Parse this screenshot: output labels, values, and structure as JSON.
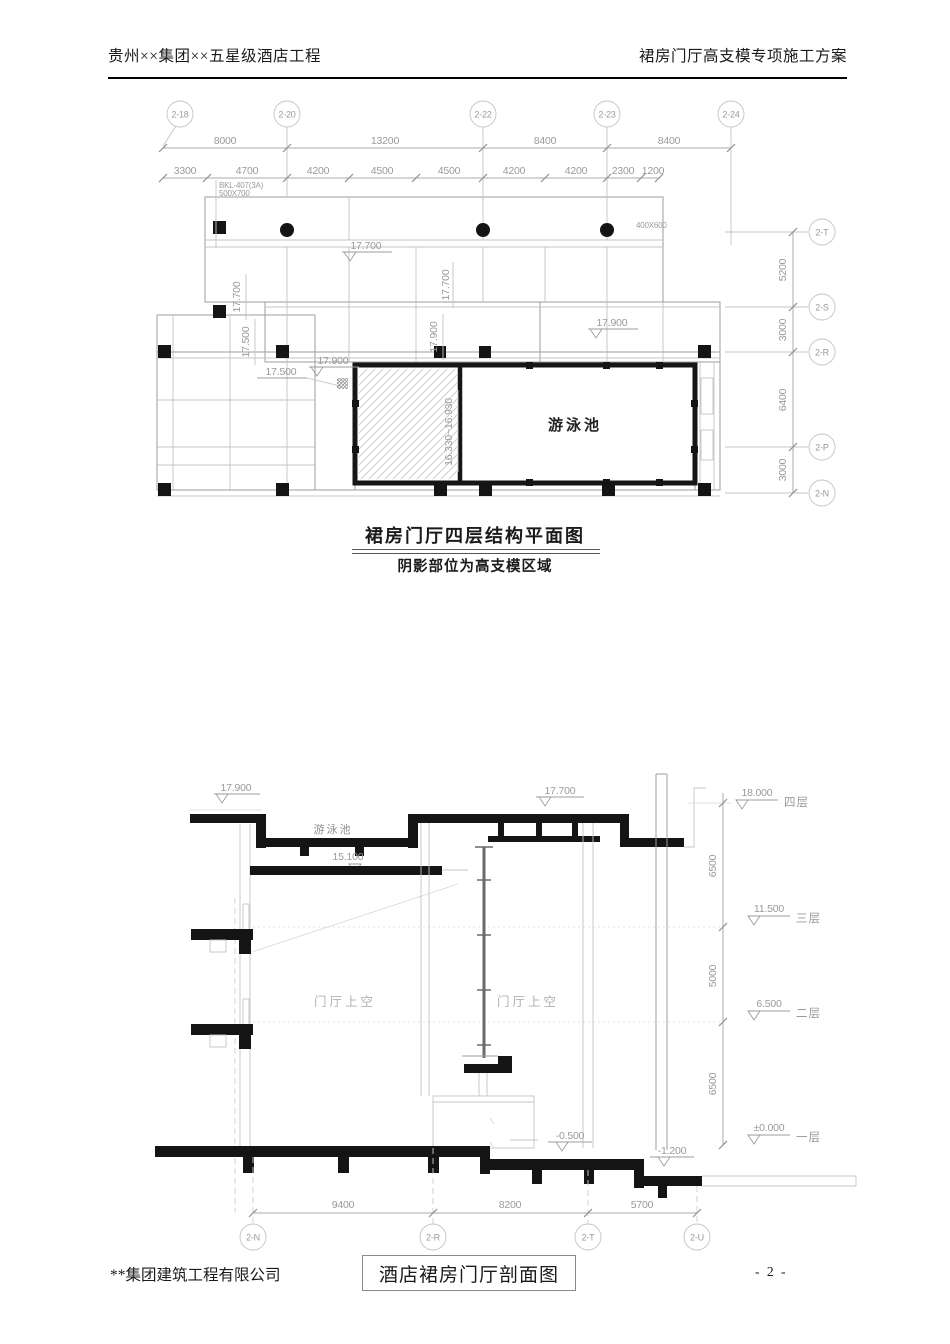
{
  "header": {
    "project": "贵州××集团××五星级酒店工程",
    "doc_title": "裙房门厅高支模专项施工方案"
  },
  "plan": {
    "title": "裙房门厅四层结构平面图",
    "subtitle": "阴影部位为高支模区域",
    "axes_top": [
      "2-18",
      "2-20",
      "2-22",
      "2-23",
      "2-24"
    ],
    "dims_row1": [
      "8000",
      "13200",
      "8400",
      "8400"
    ],
    "dims_row2": [
      "3300",
      "4700",
      "4200",
      "4500",
      "4500",
      "4200",
      "4200",
      "2300",
      "1200"
    ],
    "axes_right": [
      "2-T",
      "2-S",
      "2-R",
      "2-P",
      "2-N"
    ],
    "dims_right": [
      "5200",
      "3000",
      "6400",
      "3000"
    ],
    "beam_note_line1": "BKL-407(3A)",
    "beam_note_line2": "500X700",
    "beam_size_note": "400X600",
    "pool_label": "游泳池",
    "elev_17700": "17.700",
    "elev_17900": "17.900",
    "elev_17500": "17.500",
    "pool_elev_range": "16.330~16.930"
  },
  "section": {
    "pool_label": "游泳池",
    "void_label": "门厅上空",
    "elev_17900": "17.900",
    "elev_17700": "17.700",
    "elev_15100": "15.100",
    "elev_neg_0500": "-0.500",
    "elev_neg_1200": "-1.200",
    "levels": [
      {
        "elev": "18.000",
        "floor": "四层"
      },
      {
        "elev": "11.500",
        "floor": "三层"
      },
      {
        "elev": "6.500",
        "floor": "二层"
      },
      {
        "elev": "±0.000",
        "floor": "一层"
      }
    ],
    "dims_right": [
      "6500",
      "5000",
      "6500"
    ],
    "dims_bottom": [
      "9400",
      "8200",
      "5700"
    ],
    "axes_bottom": [
      "2-N",
      "2-R",
      "2-T",
      "2-U"
    ]
  },
  "footer": {
    "company": "**集团建筑工程有限公司",
    "drawing_title": "酒店裙房门厅剖面图",
    "page": "- 2 -"
  }
}
